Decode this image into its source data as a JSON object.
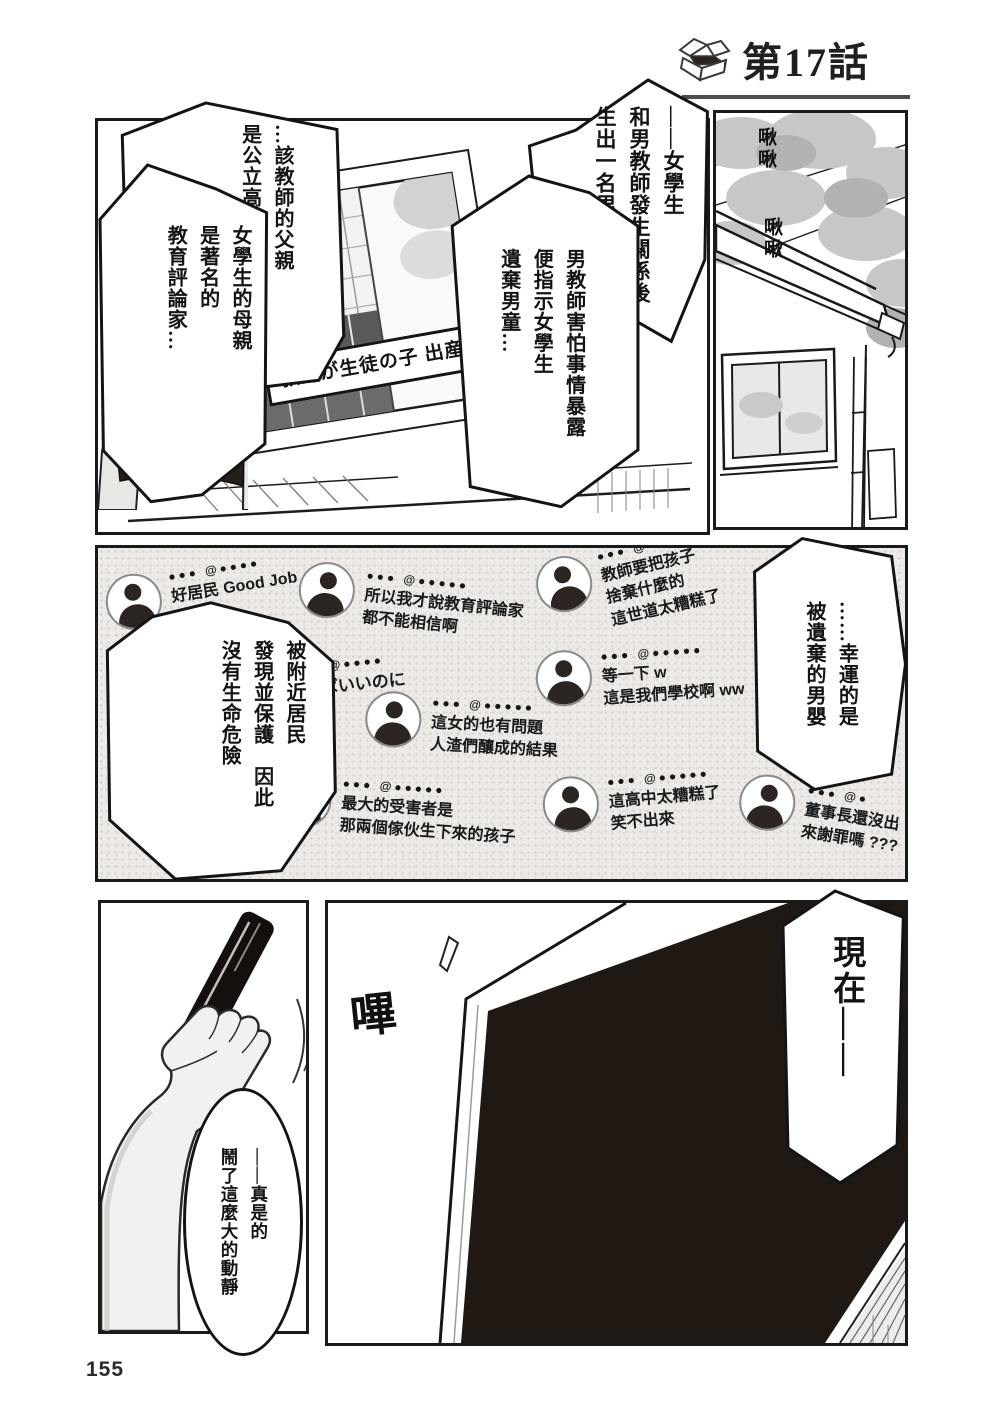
{
  "header": {
    "chapter": "第17話"
  },
  "page_number": "155",
  "panel_news": {
    "tv_caption": "教師が生徒の子 出産さ"
  },
  "sfx": {
    "chirp_top": "啾啾",
    "chirp_bottom": "啾啾",
    "beep": "嗶"
  },
  "bubbles": {
    "student": [
      "——女學生",
      "和男教師發生關係後",
      "生出一名男嬰"
    ],
    "teacher": [
      "男教師害怕事情暴露",
      "便指示女學生",
      "遺棄男童…"
    ],
    "father": [
      "…該教師的父親",
      "是公立高校的董事長"
    ],
    "mother": [
      "女學生的母親",
      "是著名的",
      "教育評論家…"
    ],
    "rescued": [
      "被附近居民",
      "發現並保護　因此",
      "沒有生命危險"
    ],
    "lucky": [
      "……幸運的是",
      "被遺棄的男嬰"
    ],
    "now": [
      "現在——"
    ],
    "commotion": [
      "——真是的",
      "鬧了這麼大的動靜"
    ]
  },
  "sns": {
    "comments": [
      {
        "handle": "●●● @●●●●",
        "lines": [
          "好居民 Good Job"
        ]
      },
      {
        "handle": "●●● @●●●●●",
        "lines": [
          "所以我才說教育評論家",
          "都不能相信啊"
        ]
      },
      {
        "handle": "●●● @●●●●",
        "lines": [
          "教師要把孩子",
          "捨棄什麼的",
          "這世道太糟糕了"
        ]
      },
      {
        "handle": "●●● @●●●●●",
        "lines": [
          "等一下 w",
          "這是我們學校啊 ww"
        ]
      },
      {
        "handle": "●●● @●●●●●",
        "lines": [
          "這女的也有問題",
          "人渣們釀成的結果"
        ]
      },
      {
        "handle": "●●● @●●●●●",
        "lines": [
          "最大的受害者是",
          "那兩個傢伙生下來的孩子"
        ]
      },
      {
        "handle": "●●● @●●●●●",
        "lines": [
          "這高中太糟糕了",
          "笑不出來"
        ]
      },
      {
        "handle": "●●● @●",
        "lines": [
          "董事長還沒出",
          "來謝罪嗎 ???"
        ]
      }
    ],
    "background_text": {
      "handle": "●● @●●●●",
      "text": "ねばいいのに"
    }
  }
}
